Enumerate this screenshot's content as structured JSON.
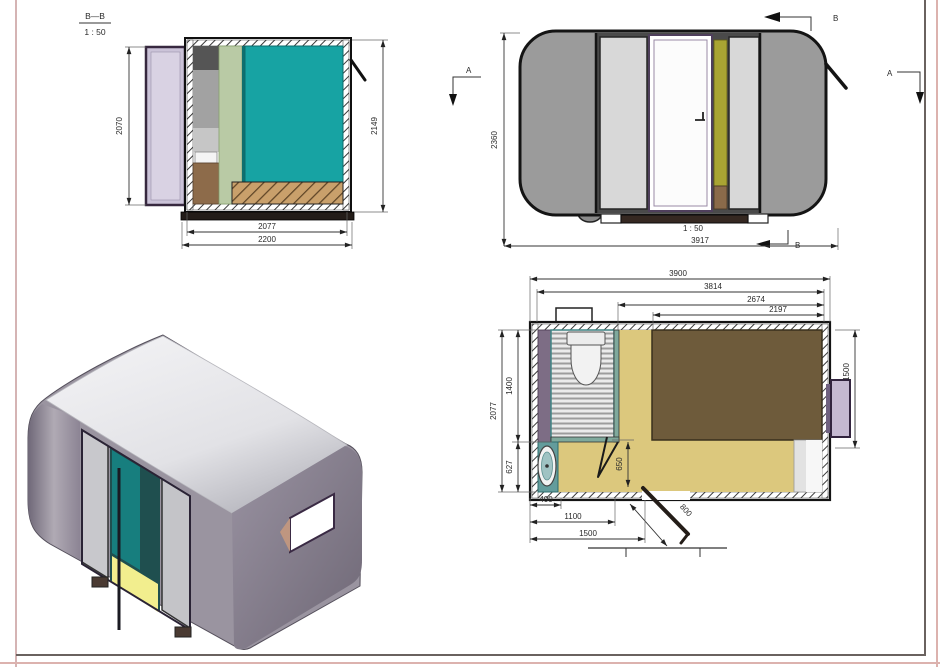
{
  "colors": {
    "teal_panel": "#17a3a3",
    "green_partition": "#b9caa5",
    "cabinet_brown": "#8d6b4a",
    "door_lavender": "#cbc3d8",
    "body_gray": "#9b9b9b",
    "olive_strip": "#a9a433",
    "plan_floor_yellow": "#dcc87d",
    "bed_brown": "#6e5b3b",
    "sink_teal": "#639c9c",
    "plan_wall_purple": "#7d6d85",
    "window_lavender": "#c5b9d1",
    "iso_roof": "#efeff2",
    "iso_side": "#8d8595",
    "line_dark": "#1c1c1c"
  },
  "section_view": {
    "label": "B—B",
    "scale": "1 : 50",
    "dim_left_height": "2070",
    "dim_right_height": "2149",
    "dim_inner_width": "2077",
    "dim_outer_width": "2200"
  },
  "side_view": {
    "scale": "1 : 50",
    "dim_height": "2360",
    "dim_length": "3917",
    "marker_b_top": "B",
    "marker_b_bottom": "B",
    "marker_a_left": "A",
    "marker_a_right": "A"
  },
  "floor_plan": {
    "dim_total_width": "3900",
    "dim_inner_width": "3814",
    "dim_bed_zone": "2674",
    "dim_bed_length": "2197",
    "dim_total_depth": "2077",
    "dim_bath_depth": "1400",
    "dim_sink_depth": "627",
    "dim_bed_width": "1500",
    "dim_400": "400",
    "dim_1100": "1100",
    "dim_1500": "1500",
    "dim_650": "650",
    "dim_door": "800"
  }
}
